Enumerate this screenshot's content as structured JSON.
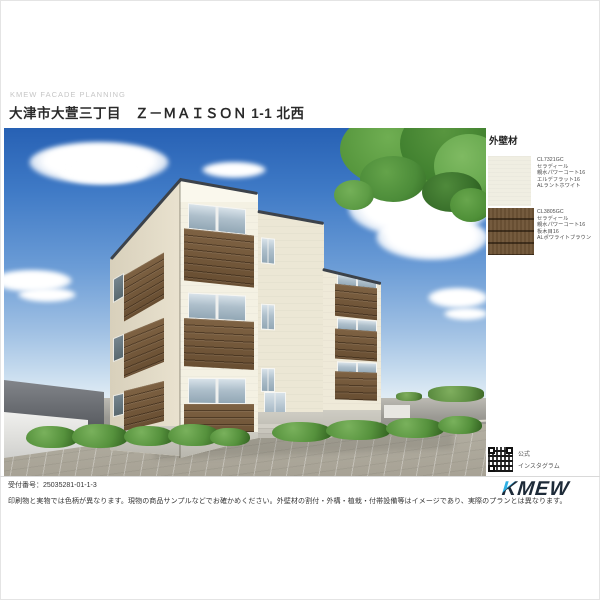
{
  "page": {
    "watermark": "KMEW FACADE PLANNING",
    "title": "大津市大萱三丁目　Ｚ－ＭＡＩＳＯＮ 1-1 北西",
    "receipt_number": "受付番号：25035281-01-1-3",
    "disclaimer": "印刷物と実物では色柄が異なります。現物の商品サンプルなどでお確かめください。外壁材の割付・外構・植栽・付帯設備等はイメージであり、実際のプランとは異なります。",
    "logo": {
      "k": "K",
      "rest": "MEW",
      "accent_color": "#2fb0e4",
      "text_color": "#1d2a38"
    }
  },
  "materials_panel": {
    "heading": "外壁材",
    "swatches": [
      {
        "id": "exterior-white",
        "color": "#f0eee2",
        "lines": [
          "CL7321GC",
          "セラディール",
          "親水パワーコート16",
          "エルデフラット16",
          "ALラントホワイト"
        ]
      },
      {
        "id": "exterior-brown",
        "color": "#6f5436",
        "lines": [
          "CL3805GC",
          "セラディール",
          "親水パワーコート16",
          "板木目16",
          "ALポワライトブラウン"
        ]
      }
    ],
    "instagram": {
      "line1": "公式",
      "line2": "インスタグラム"
    }
  },
  "rendering_colors": {
    "sky_top": "#2761b4",
    "wall_cream": "#f2efe1",
    "balcony_brown": "#74583a"
  }
}
